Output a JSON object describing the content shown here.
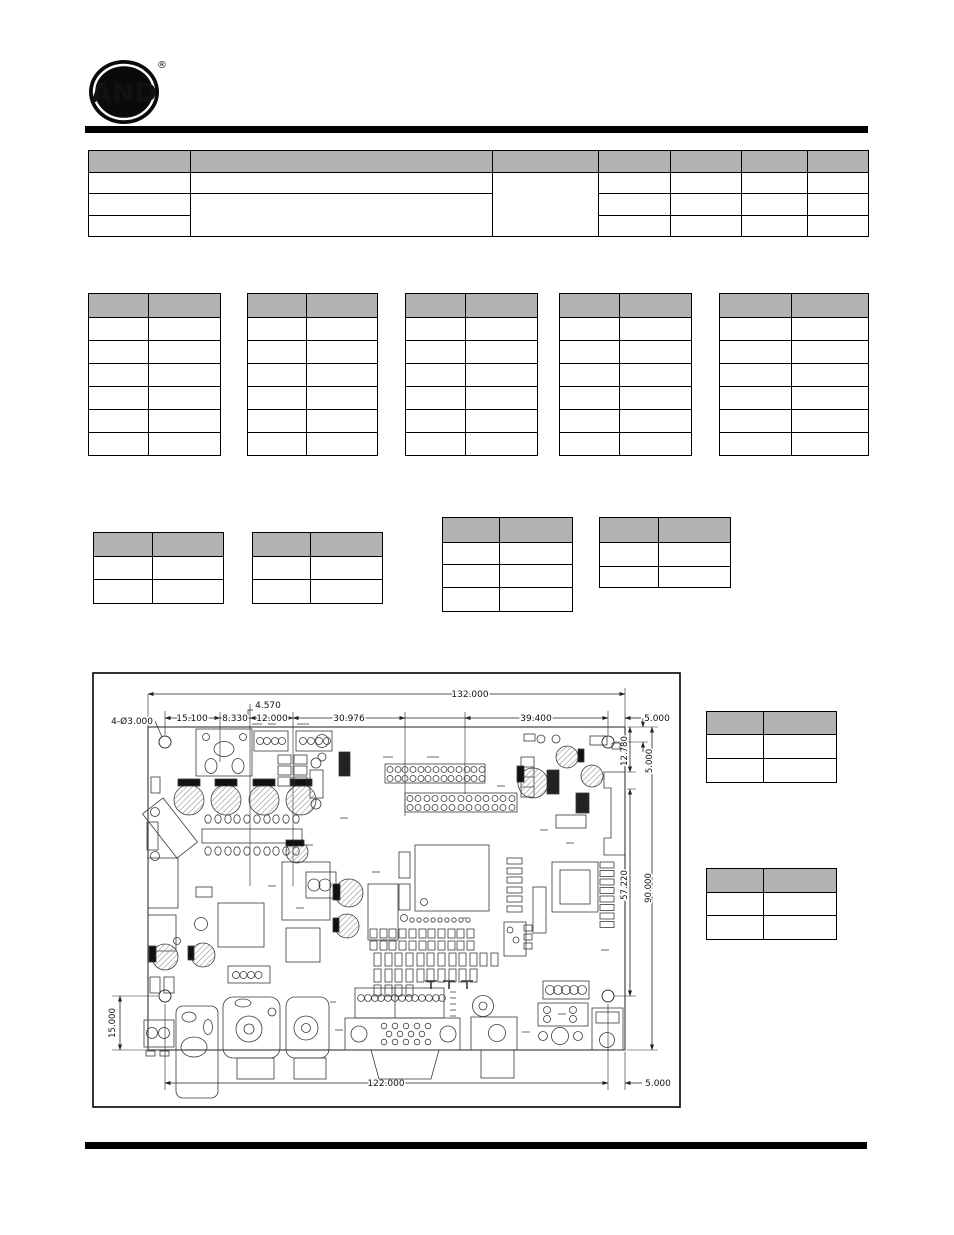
{
  "logo": {
    "text": "AND",
    "registered": "®"
  },
  "colors": {
    "table_header": "#b2b2b2",
    "rule": "#000000"
  },
  "figure": {
    "dims": {
      "overall_width": "132.000",
      "seg_15_1": "15.100",
      "seg_8_33": "8.330",
      "offset_4_57": "4.570",
      "seg_12": "12.000",
      "seg_30_976": "30.976",
      "seg_39_4": "39.400",
      "edge_5_top": "5.000",
      "hole_callout": "4-Ø3.000",
      "v_12_78": "12.780",
      "v_5": "5.000",
      "v_57_22": "57.220",
      "v_90": "90.000",
      "left_15": "15.000",
      "bottom_122": "122.000",
      "bottom_5": "5.000"
    }
  }
}
